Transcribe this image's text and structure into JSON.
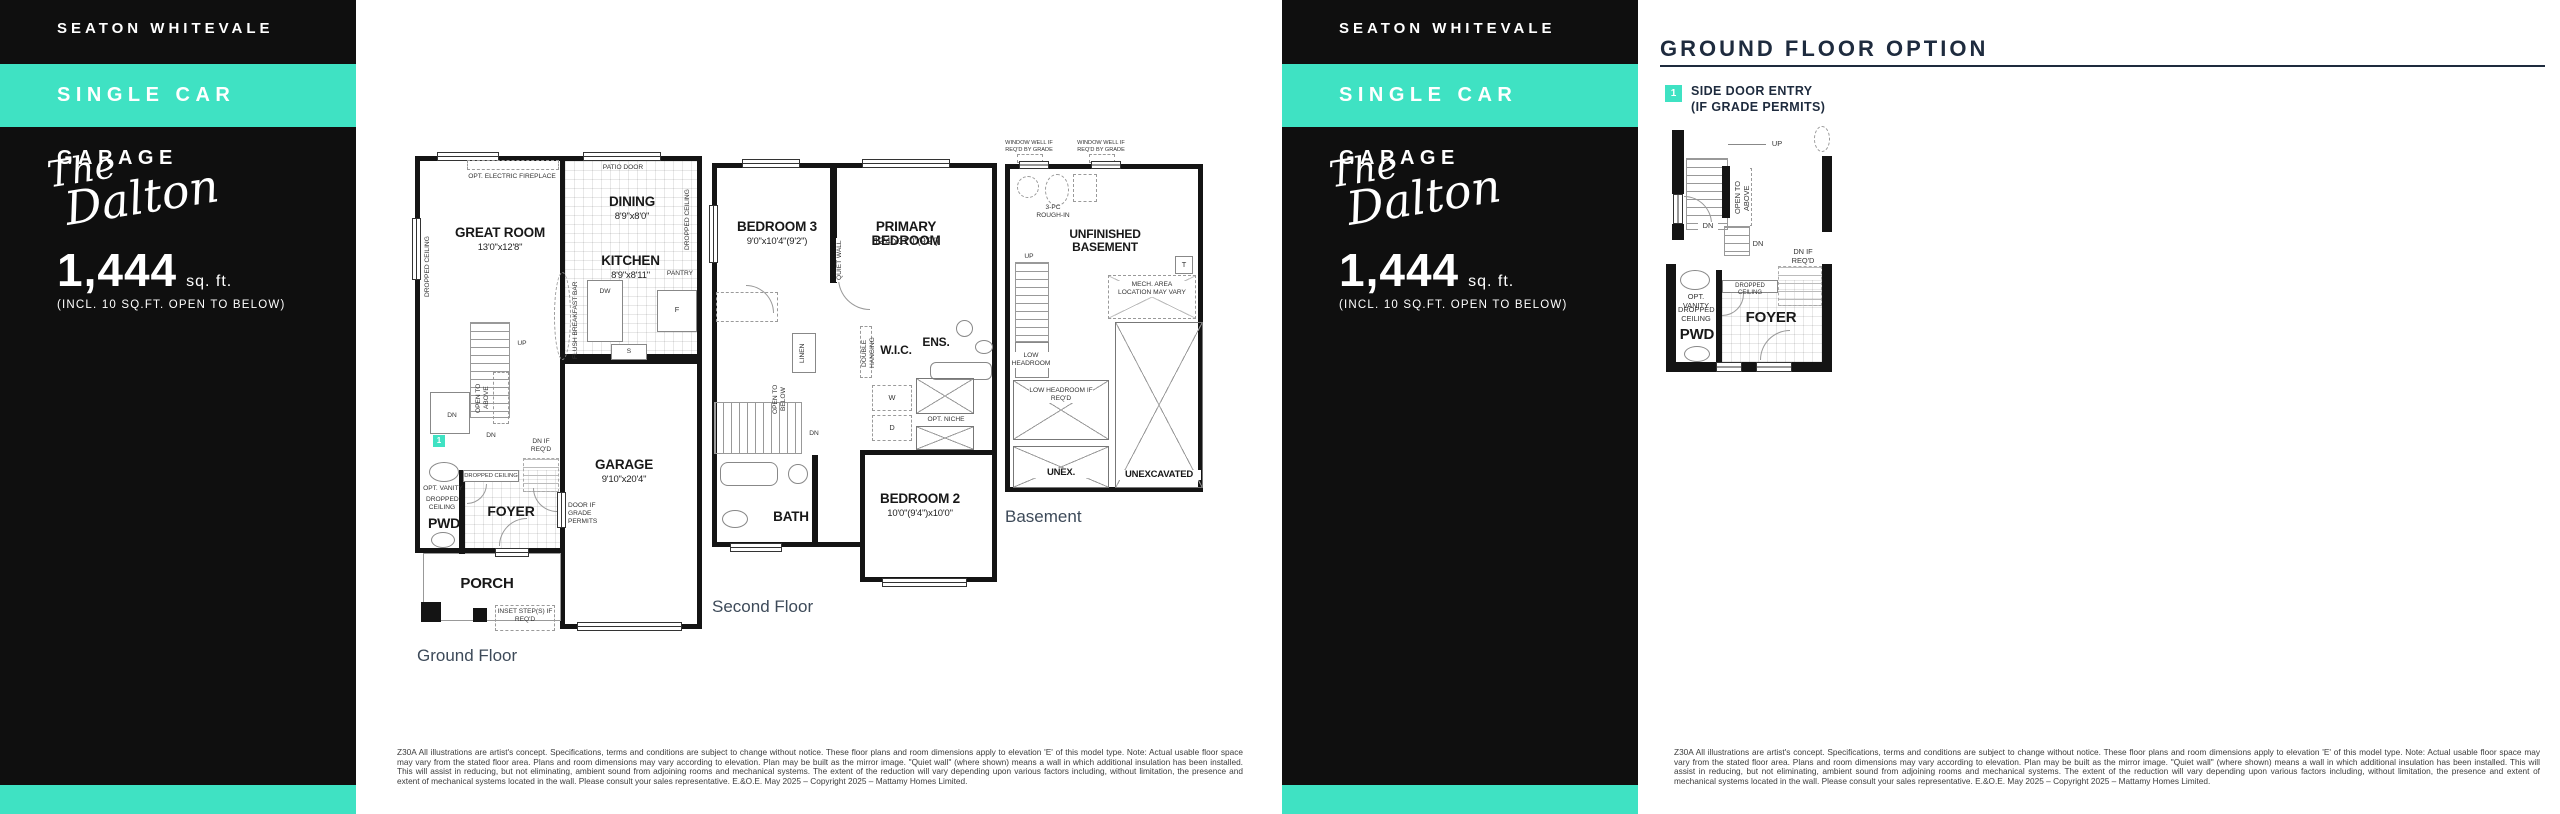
{
  "colors": {
    "teal": "#3fe2c3",
    "sidebar_black": "#0f0f0f",
    "heading_navy": "#1e2b3e",
    "caption_gray": "#3d4a59"
  },
  "sidebar": {
    "community": "SEATON WHITEVALE",
    "banner": "SINGLE CAR GARAGE",
    "model_line1": "The",
    "model_line2": "Dalton",
    "sqft": "1,444",
    "sqft_unit": "sq. ft.",
    "sqft_note": "(INCL. 10 SQ.FT. OPEN TO BELOW)"
  },
  "option": {
    "title": "GROUND FLOOR OPTION",
    "marker": "1",
    "legend_line1": "SIDE DOOR ENTRY",
    "legend_line2": "(IF GRADE PERMITS)"
  },
  "shared": {
    "up": "UP",
    "dn": "DN",
    "dn_if_reqd": "DN IF REQ'D",
    "dropped_ceiling": "DROPPED CEILING",
    "open_to_above": "OPEN TO ABOVE",
    "open_to_below": "OPEN TO BELOW",
    "opt_vanity": "OPT. VANITY",
    "pwd": "PWD",
    "foyer": "FOYER"
  },
  "ground": {
    "caption": "Ground Floor",
    "opt_fireplace": "OPT. ELECTRIC FIREPLACE",
    "patio_door": "PATIO DOOR",
    "great_room": "GREAT ROOM",
    "great_room_dim": "13'0\"x12'8\"",
    "dining": "DINING",
    "dining_dim": "8'9\"x8'0\"",
    "kitchen": "KITCHEN",
    "kitchen_dim": "8'9\"x8'11\"",
    "pantry": "PANTRY",
    "fridge": "F",
    "sink": "S",
    "dw": "DW",
    "flush_bar": "FLUSH BREAKFAST BAR",
    "garage": "GARAGE",
    "garage_dim": "9'10\"x20'4\"",
    "door_grade": "DOOR IF GRADE PERMITS",
    "porch": "PORCH",
    "inset_steps": "INSET STEP(S) IF REQ'D",
    "marker": "1"
  },
  "second": {
    "caption": "Second Floor",
    "bedroom3": "BEDROOM 3",
    "bedroom3_dim": "9'0\"x10'4\"(9'2\")",
    "primary": "PRIMARY BEDROOM",
    "primary_dim": "12'4\"x11'0\"(9'2\")",
    "quiet_wall": "QUIET WALL",
    "linen": "LINEN",
    "double_hanging": "DOUBLE HANGING",
    "wic": "W.I.C.",
    "ens": "ENS.",
    "washer": "W",
    "dryer": "D",
    "opt_niche": "OPT. NICHE",
    "bath": "BATH",
    "bedroom2": "BEDROOM 2",
    "bedroom2_dim": "10'0\"(9'4\")x10'0\""
  },
  "basement": {
    "caption": "Basement",
    "window_well": "WINDOW WELL IF REQ'D BY GRADE",
    "rough_in": "3-PC ROUGH-IN",
    "unfinished": "UNFINISHED BASEMENT",
    "tank": "T",
    "mech": "MECH. AREA LOCATION MAY VARY",
    "low_headroom": "LOW HEADROOM",
    "low_headroom_if": "LOW HEADROOM IF REQ'D",
    "unex": "UNEX.",
    "unexcavated": "UNEXCAVATED"
  },
  "disclaimer": "Z30A All illustrations are artist's concept. Specifications, terms and conditions are subject to change without notice. These floor plans and room dimensions apply to elevation 'E' of this model type. Note: Actual usable floor space may vary from the stated floor area. Plans and room dimensions may vary according to elevation. Plan may be built as the mirror image. \"Quiet wall\" (where shown) means a wall in which additional insulation has been installed. This will assist in reducing, but not eliminating, ambient sound from adjoining rooms and mechanical systems. The extent of the reduction will vary depending upon various factors including, without limitation, the presence and extent of mechanical systems located in the wall. Please consult your sales representative. E.&O.E. May 2025 – Copyright 2025 – Mattamy Homes Limited."
}
